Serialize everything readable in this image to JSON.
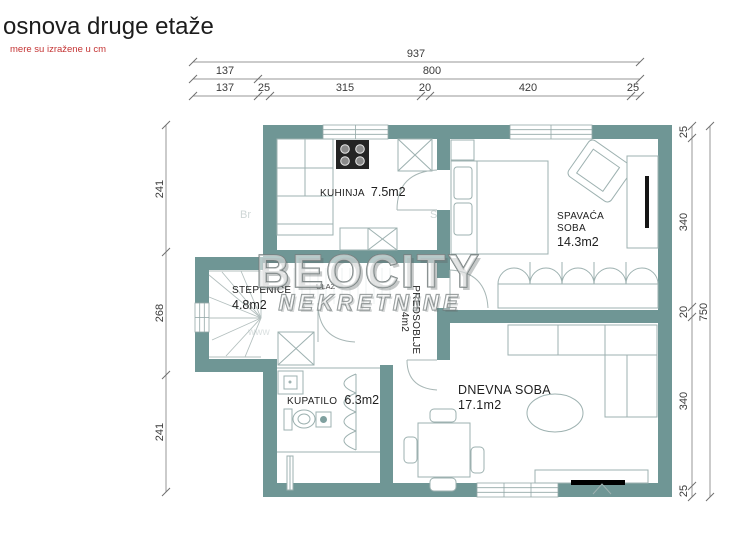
{
  "header": {
    "title": "osnova druge etaže",
    "note": "mere su izražene u cm"
  },
  "watermark": {
    "brand": "BEOCITY",
    "sub": "NEKRETNINE",
    "ghost_left": "Br",
    "ghost_mid": "S",
    "ghost_bottom": "www"
  },
  "rooms": {
    "kuhinja": {
      "name": "KUHINJA",
      "area": "7.5m2"
    },
    "spavaca_soba": {
      "name_line1": "SPAVAĆA",
      "name_line2": "SOBA",
      "area": "14.3m2"
    },
    "stepenice": {
      "name": "STEPENICE",
      "area": "4.8m2"
    },
    "ulaz": {
      "name": "ULAZ"
    },
    "predsoblje": {
      "name": "PREDSOBLJE",
      "area": "4m2"
    },
    "kupatilo": {
      "name": "KUPATILO",
      "area": "6.3m2"
    },
    "dnevna_soba": {
      "name": "DNEVNA SOBA",
      "area": "17.1m2"
    }
  },
  "dims": {
    "top_total": "937",
    "top_row2": [
      "137",
      "800"
    ],
    "top_row3": [
      "137",
      "25",
      "315",
      "20",
      "420",
      "25"
    ],
    "left_column": [
      "241",
      "268",
      "241"
    ],
    "right_column": [
      "25",
      "340",
      "20",
      "340",
      "25"
    ],
    "right_total": "750"
  },
  "colors": {
    "wall": "#6F9695",
    "note_red": "#c43434",
    "dimension_text": "#3b3b3b",
    "title_text": "#1c1c1c"
  }
}
